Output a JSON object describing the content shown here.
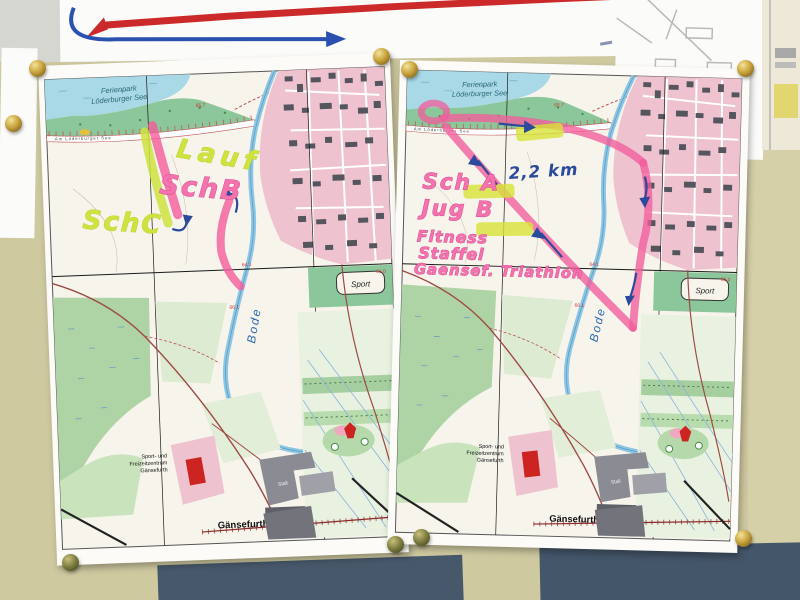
{
  "map_labels": {
    "ferienpark_line1": "Ferienpark",
    "ferienpark_line2": "Löderburger See",
    "road_name": "Am Löderburger See",
    "river_name": "Bode",
    "sport_label": "Sport",
    "stall_label": "Stall",
    "center_line1": "Sport- und",
    "center_line2": "Freizeitzentrum",
    "center_line3": "Gänsefurth",
    "town_label": "Gänsefurth",
    "elevations": {
      "e1": "65.7",
      "e2": "64.1",
      "e3": "66.0",
      "e4": "65.2",
      "e5": "66.1"
    }
  },
  "annotations": {
    "left_sheet": {
      "route_name_top": "Lauf",
      "route_b": "SchB",
      "route_c": "SchC"
    },
    "right_sheet": {
      "class_a": "Sch A",
      "youth_b": "Jug B",
      "fitness": "Fitness",
      "relay": "Staffel",
      "event": "Gaensef. Triathlon",
      "distance": "2,2 km"
    }
  },
  "colors": {
    "route_highlight_pink": "#f25c9b",
    "route_highlight_green": "#cde23c",
    "pen_blue": "#2b4a9b",
    "town_pink": "#eec3cf",
    "water_blue": "#a9d8e6"
  }
}
